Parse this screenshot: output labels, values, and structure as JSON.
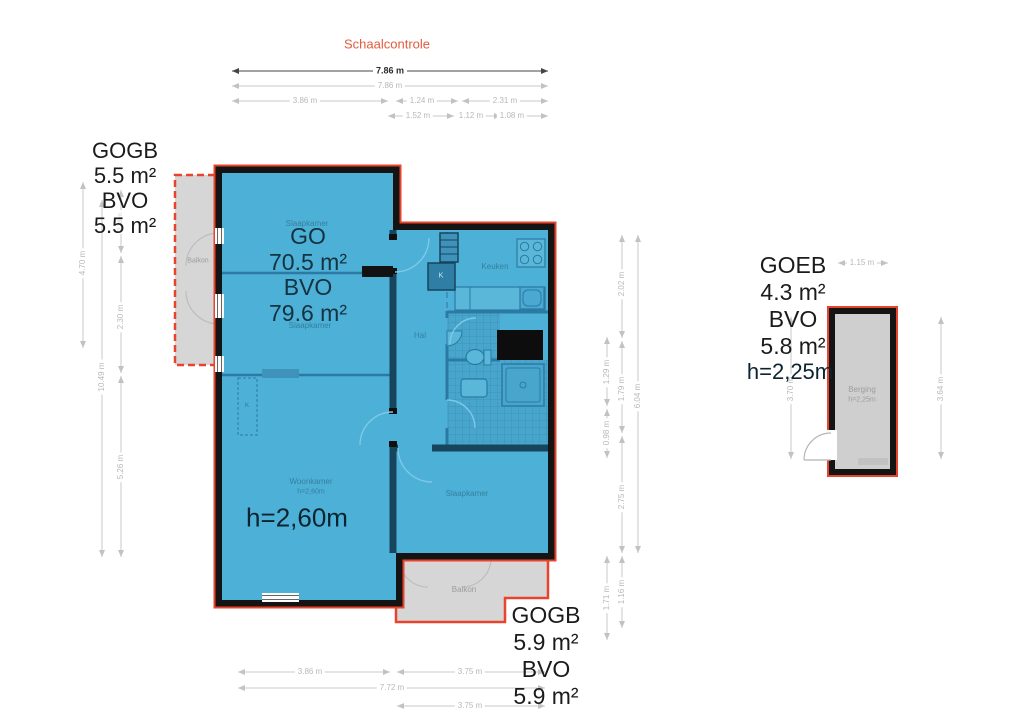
{
  "header": {
    "title": "Schaalcontrole"
  },
  "colors": {
    "outline_red": "#e8432c",
    "floor_blue": "#4db0d7",
    "wall_black": "#141414",
    "balcony_gray": "#d6d6d6",
    "dim_gray": "#c0c0c0"
  },
  "area_labels": {
    "top_left": {
      "lines": [
        "GOGB",
        "5.5 m²",
        "BVO",
        "5.5 m²"
      ]
    },
    "main": {
      "lines": [
        "GO",
        "70.5 m²",
        "BVO",
        "79.6 m²"
      ],
      "height": "h=2,60m"
    },
    "storage": {
      "lines": [
        "GOEB",
        "4.3 m²",
        "BVO",
        "5.8 m²"
      ],
      "height": "h=2,25m"
    },
    "bottom_right": {
      "lines": [
        "GOGB",
        "5.9 m²",
        "BVO",
        "5.9 m²"
      ]
    }
  },
  "rooms": {
    "bedroom1": "Slaapkamer",
    "bedroom2": "Slaapkamer",
    "bedroom3": "Slaapkamer",
    "kitchen": "Keuken",
    "hall": "Hal",
    "living": "Woonkamer",
    "living_height": "h=2,60m",
    "balcony_left": "Balkon",
    "balcony_bottom": "Balkon",
    "storage": "Berging",
    "storage_height": "h=2,25m",
    "closet_kitchen": "K",
    "closet_living": "K"
  },
  "dims": {
    "top": [
      "7.86 m",
      "7.86 m",
      "3.86 m",
      "1.24 m",
      "2.31 m",
      "1.52 m",
      "1.12 m",
      "1.08 m"
    ],
    "left": [
      "4.70 m",
      "10.49 m",
      "2.38 m",
      "2.30 m",
      "5.26 m"
    ],
    "right": [
      "1.29 m",
      "0.98 m",
      "1.71 m",
      "2.02 m",
      "1.79 m",
      "2.75 m",
      "1.16 m",
      "6.04 m"
    ],
    "bottom": [
      "3.86 m",
      "3.75 m",
      "7.72 m",
      "3.75 m"
    ],
    "storage": [
      "1.15 m",
      "3.70 m",
      "3.64 m"
    ]
  }
}
